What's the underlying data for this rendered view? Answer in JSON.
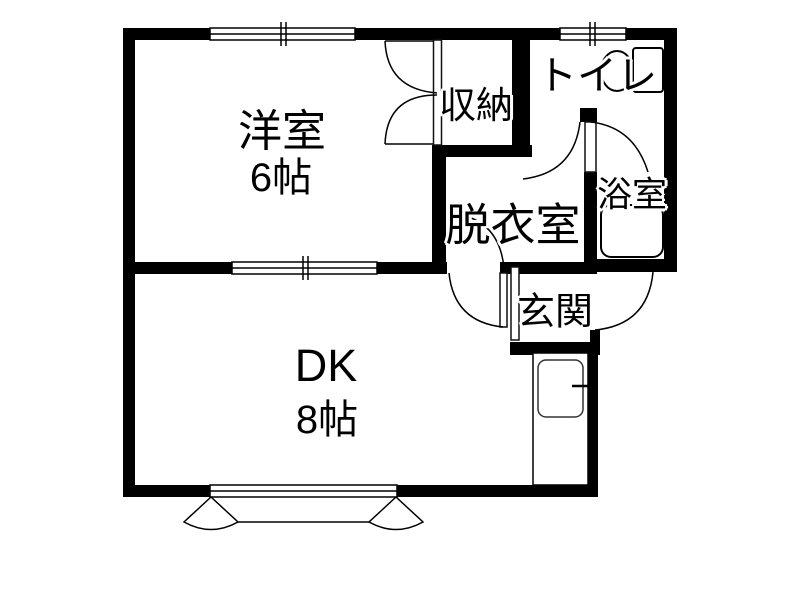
{
  "plan": {
    "type": "apartment-floor-plan",
    "layout_code": "1DK"
  },
  "rooms": {
    "western": {
      "label": "洋室",
      "size": "6帖"
    },
    "dk": {
      "label": "DK",
      "size": "8帖"
    },
    "closet": {
      "label": "収納"
    },
    "toilet": {
      "label": "トイレ"
    },
    "washroom": {
      "label": "脱衣室"
    },
    "bath": {
      "label": "浴室"
    },
    "entrance": {
      "label": "玄関"
    }
  },
  "fixtures": {
    "toilet_unit": "toilet-bowl-and-tank",
    "bathtub": "bathtub",
    "kitchen": "kitchen-counter-with-sink"
  },
  "colors": {
    "wall": "#000000",
    "background": "#ffffff",
    "line": "#000000"
  }
}
